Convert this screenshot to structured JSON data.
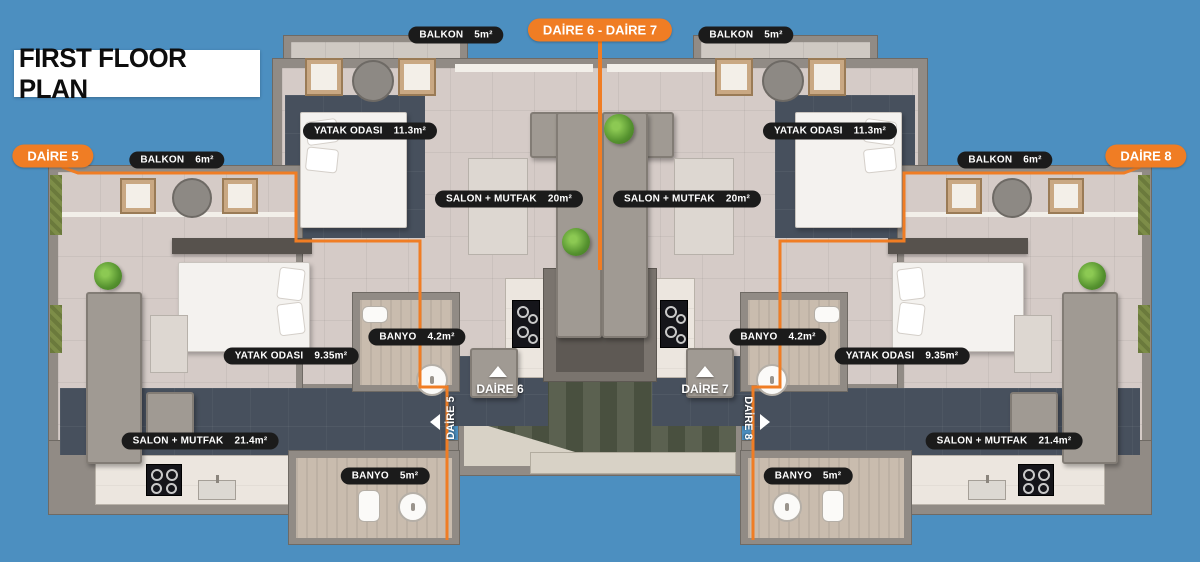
{
  "title": "FIRST FLOOR PLAN",
  "colors": {
    "background": "#4c8fc0",
    "accent_orange": "#f07d24",
    "label_bg": "#1b1b1b",
    "label_text": "#ffffff",
    "wall_gray": "#918b85",
    "floor_dark": "#47505d"
  },
  "badges": {
    "daire5": "DAİRE 5",
    "daire6_7": "DAİRE 6  -  DAİRE 7",
    "daire8": "DAİRE 8"
  },
  "entrances": {
    "daire5": "DAİRE 5",
    "daire6": "DAİRE 6",
    "daire7": "DAİRE 7",
    "daire8": "DAİRE 8"
  },
  "elevator_label": "ASANSÖR",
  "rooms": {
    "balkon_top_left": {
      "name": "BALKON",
      "area": "5m²"
    },
    "balkon_top_right": {
      "name": "BALKON",
      "area": "5m²"
    },
    "balkon_left": {
      "name": "BALKON",
      "area": "6m²"
    },
    "balkon_right": {
      "name": "BALKON",
      "area": "6m²"
    },
    "yatak_left_big": {
      "name": "YATAK ODASI",
      "area": "11.3m²"
    },
    "yatak_right_big": {
      "name": "YATAK ODASI",
      "area": "11.3m²"
    },
    "salon_left_small": {
      "name": "SALON + MUTFAK",
      "area": "20m²"
    },
    "salon_right_small": {
      "name": "SALON + MUTFAK",
      "area": "20m²"
    },
    "banyo_left_small": {
      "name": "BANYO",
      "area": "4.2m²"
    },
    "banyo_right_small": {
      "name": "BANYO",
      "area": "4.2m²"
    },
    "yatak_left_small": {
      "name": "YATAK ODASI",
      "area": "9.35m²"
    },
    "yatak_right_small": {
      "name": "YATAK ODASI",
      "area": "9.35m²"
    },
    "salon_left_big": {
      "name": "SALON + MUTFAK",
      "area": "21.4m²"
    },
    "salon_right_big": {
      "name": "SALON + MUTFAK",
      "area": "21.4m²"
    },
    "banyo_left_bottom": {
      "name": "BANYO",
      "area": "5m²"
    },
    "banyo_right_bottom": {
      "name": "BANYO",
      "area": "5m²"
    }
  }
}
